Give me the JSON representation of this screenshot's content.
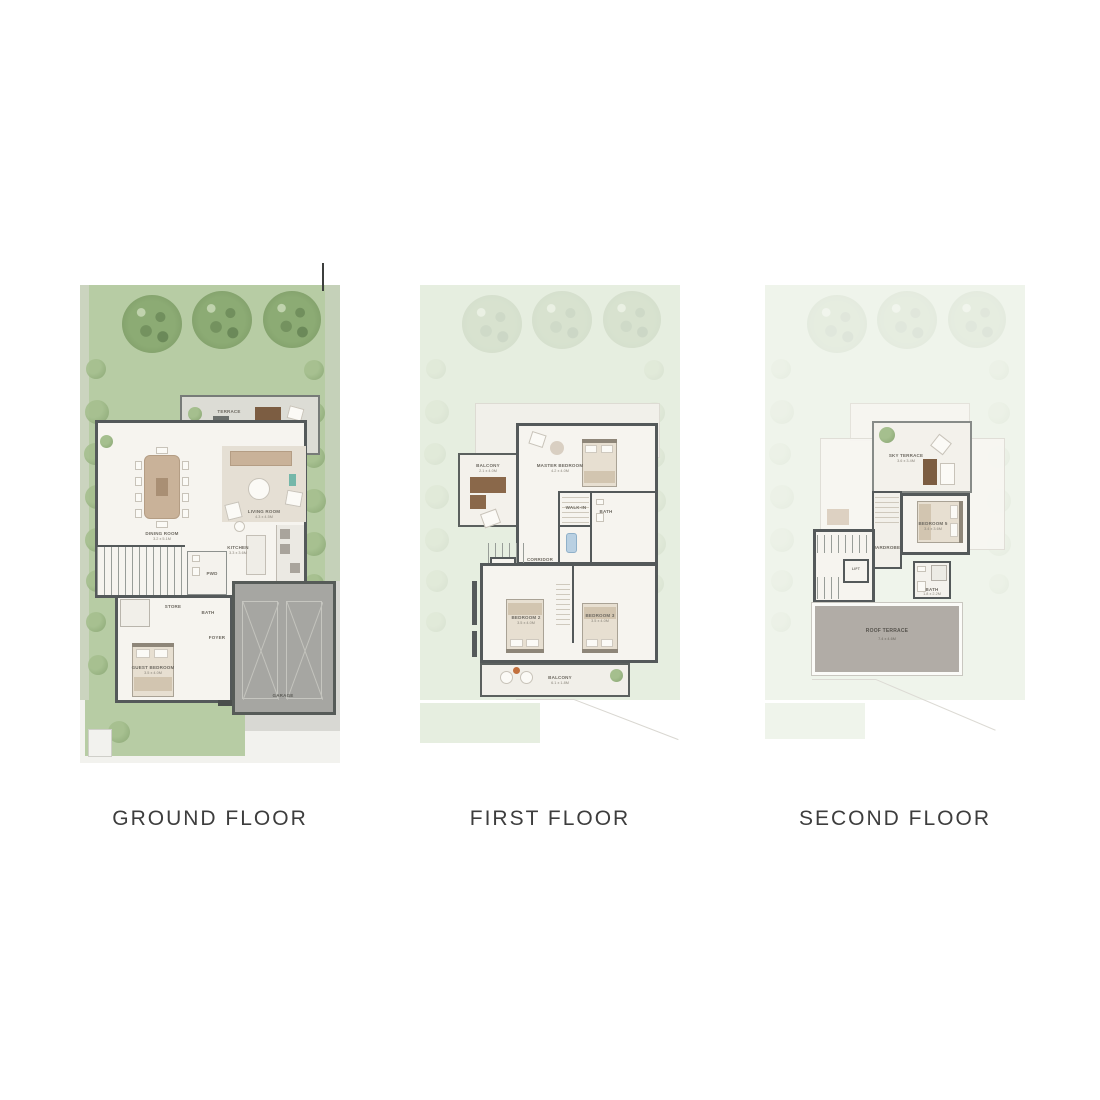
{
  "captions": {
    "ground": "GROUND FLOOR",
    "first": "FIRST FLOOR",
    "second": "SECOND FLOOR"
  },
  "colors": {
    "lawn": "#b7cca4",
    "tree": "#85a170",
    "wall": "#54595a",
    "floor": "#f6f4ef",
    "terrace_floor": "#dcdcd5",
    "garage": "#a6a6a2",
    "roof_terrace": "#b1aca6",
    "wood": "#7c5d42",
    "caption_text": "#3d3d3d"
  },
  "plans": {
    "ground": {
      "labels": {
        "terrace": "TERRACE",
        "dining": "DINING ROOM",
        "dining_dims": "3.2 x 5.1M",
        "living": "LIVING ROOM",
        "living_dims": "4.3 x 4.5M",
        "kitchen": "KITCHEN",
        "kitchen_dims": "3.3 x 3.6M",
        "powder": "PWD",
        "laundry": "LAUNDRY",
        "store": "STORE",
        "bath": "BATH",
        "foyer": "FOYER",
        "bedroom": "GUEST BEDROOM",
        "bedroom_dims": "3.5 x 4.0M",
        "garage": "GARAGE"
      }
    },
    "first": {
      "labels": {
        "balcony_upper": "BALCONY",
        "balcony_upper_dims": "2.1 x 4.0M",
        "master": "MASTER BEDROOM",
        "master_dims": "4.2 x 4.0M",
        "walkin": "WALK-IN",
        "bath": "BATH",
        "corridor": "CORRIDOR",
        "lift": "LIFT",
        "bedroom2": "BEDROOM 2",
        "bedroom2_dims": "3.5 x 4.0M",
        "bedroom3": "BEDROOM 3",
        "bedroom3_dims": "3.5 x 4.0M",
        "balcony_lower": "BALCONY",
        "balcony_lower_dims": "6.1 x 1.8M"
      }
    },
    "second": {
      "labels": {
        "sky_terrace": "SKY TERRACE",
        "sky_terrace_dims": "3.6 x 3.4M",
        "bedroom": "BEDROOM 5",
        "bedroom_dims": "3.4 x 3.6M",
        "wardrobe": "WARDROBE",
        "lift": "LIFT",
        "bath": "BATH",
        "bath_dims": "1.8 x 2.2M",
        "roof_terrace": "ROOF TERRACE",
        "roof_terrace_dims": "7.4 x 4.6M"
      }
    }
  }
}
